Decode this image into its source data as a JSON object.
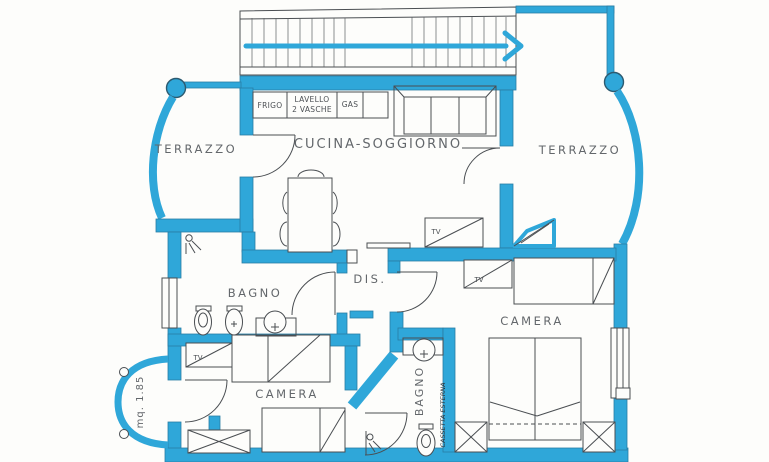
{
  "plan": {
    "type": "apartment-floor-plan",
    "colors": {
      "wall_highlight": "#2fa7d9",
      "pen_line": "#4a4e52",
      "paper": "#fdfdfb",
      "label_text": "#63676b"
    }
  },
  "rooms": {
    "terrazzo_left": {
      "label": "TERRAZZO"
    },
    "terrazzo_right": {
      "label": "TERRAZZO"
    },
    "cucina_soggiorno": {
      "label": "CUCINA-SOGGIORNO"
    },
    "bagno1": {
      "label": "BAGNO"
    },
    "dis": {
      "label": "DIS."
    },
    "camera1": {
      "label": "CAMERA"
    },
    "camera2": {
      "label": "CAMERA"
    },
    "bagno2": {
      "label": "BAGNO"
    },
    "balcony": {
      "label": "mq. 1.85"
    }
  },
  "kitchen_units": {
    "frigo": "FRIGO",
    "lavello_line1": "LAVELLO",
    "lavello_line2": "2 VASCHE",
    "gas": "GAS"
  },
  "tv_labels": {
    "soggiorno": "TV",
    "camera2": "TV",
    "camera1": "TV"
  },
  "annotations": {
    "cassetta": "CASSETTA ESTERNA"
  }
}
